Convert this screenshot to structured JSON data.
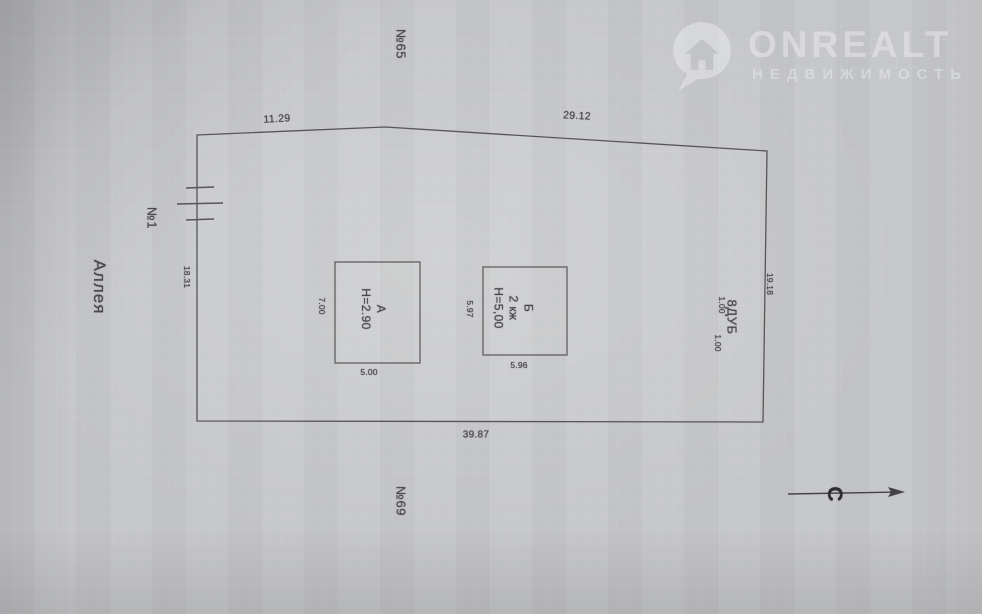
{
  "watermark": {
    "brand": "ONREALT",
    "subtitle": "НЕДВИЖИМОСТЬ",
    "icon": "house-pin-icon"
  },
  "plan": {
    "adjacent_labels": {
      "top_plot": "№65",
      "left_plot": "№1",
      "street": "Аллея",
      "bottom_plot": "№69"
    },
    "boundary_dims": {
      "top_left": "11.29",
      "top_right": "29.12",
      "left": "18.31",
      "right": "19.18",
      "bottom": "39.87"
    },
    "building_a": {
      "label": "А",
      "height": "Н=2.90",
      "side_dim": "7.00",
      "bottom_dim": "5.00"
    },
    "building_b": {
      "label": "Б",
      "storeys": "2 кж",
      "height": "Н=5,00",
      "side_dim": "5.97",
      "bottom_dim": "5.96"
    },
    "tree": {
      "label": "8ДУБ",
      "offset_top": "1.00",
      "offset_bottom": "1.00"
    },
    "compass_north": "С"
  },
  "colors": {
    "paper": "#c4c5c7",
    "ink": "#48484a",
    "watermark": "rgba(245,246,248,0.42)"
  }
}
